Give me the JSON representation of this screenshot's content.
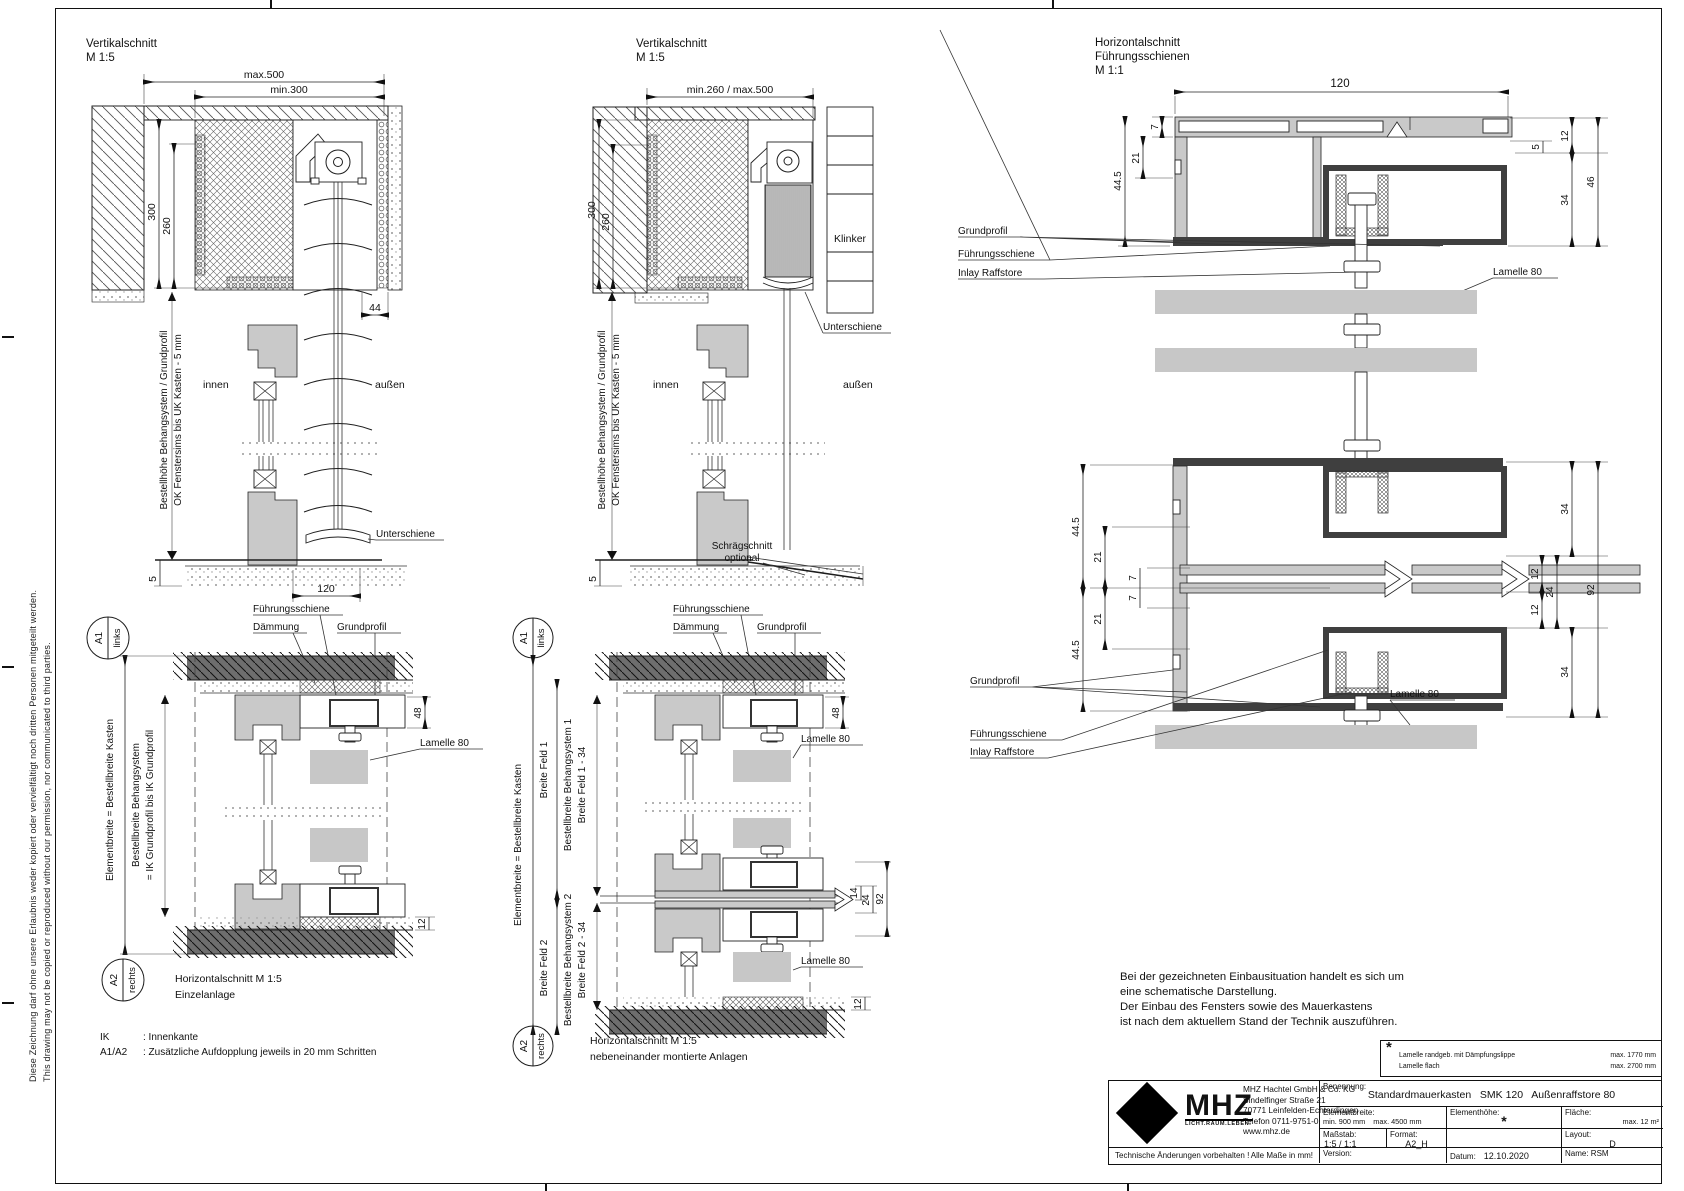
{
  "sheet": {
    "copyright_de": "Diese Zeichnung darf ohne unsere Erlaubnis weder kopiert oder vervielfältigt noch dritten Personen mitgeteilt werden.",
    "copyright_en": "This drawing may not be copied or reproduced without our permission, nor communicated to third parties."
  },
  "vs1": {
    "title": "Vertikalschnitt",
    "scale": "M 1:5",
    "d_max": "max.500",
    "d_min": "min.300",
    "d_300": "300",
    "d_260": "260",
    "d_44": "44",
    "d_120": "120",
    "d_5": "5",
    "innen": "innen",
    "aussen": "außen",
    "unterschiene": "Unterschiene",
    "v1": "Bestellhöhe Behangsystem / Grundprofil",
    "v2": "OK Fenstersims  bis UK Kasten - 5 mm"
  },
  "vs2": {
    "title": "Vertikalschnitt",
    "scale": "M 1:5",
    "d_span": "min.260 / max.500",
    "d_300": "300",
    "d_260": "260",
    "d_5": "5",
    "innen": "innen",
    "aussen": "außen",
    "klinker": "Klinker",
    "unterschiene": "Unterschiene",
    "schraeg1": "Schrägschnitt",
    "schraeg2": "optional",
    "v1": "Bestellhöhe Behangsystem / Grundprofil",
    "v2": "OK Fenstersims  bis UK Kasten - 5 mm"
  },
  "hs11": {
    "title_1": "Horizontalschnitt",
    "title_2": "Führungsschienen",
    "scale": "M 1:1",
    "d_120": "120",
    "d_7": "7",
    "d_21": "21",
    "d_445": "44.5",
    "d_5": "5",
    "d_12": "12",
    "d_34": "34",
    "d_46": "46",
    "lbl_grundprofil": "Grundprofil",
    "lbl_fuehrung": "Führungsschiene",
    "lbl_inlay": "Inlay Raffstore",
    "lbl_lamelle": "Lamelle 80",
    "lbl_grundprofil2": "Grundprofil",
    "lbl_fuehrung2": "Führungsschiene",
    "lbl_inlay2": "Inlay Raffstore",
    "lbl_lamelle2": "Lamelle 80",
    "m_445a": "44.5",
    "m_21a": "21",
    "m_7a": "7",
    "m_7b": "7",
    "m_21b": "21",
    "m_445b": "44.5",
    "m_34a": "34",
    "m_12a": "12",
    "m_24": "24",
    "m_12b": "12",
    "m_34b": "34",
    "m_92": "92"
  },
  "hs15a": {
    "a1": "A1",
    "a1dir": "links",
    "a2": "A2",
    "a2dir": "rechts",
    "lbl_fuehrung": "Führungsschiene",
    "lbl_daemmung": "Dämmung",
    "lbl_grund": "Grundprofil",
    "lbl_lamelle": "Lamelle 80",
    "dim_48": "48",
    "dim_12": "12",
    "v_element": "Elementbreite = Bestellbreite Kasten",
    "v_bestell1": "Bestellbreite Behangsystem",
    "v_bestell2": "= IK Grundprofil bis IK Grundprofil",
    "title": "Horizontalschnitt M 1:5",
    "subtitle": "Einzelanlage",
    "ik_term": "IK",
    "ik_def": ": Innenkante",
    "a_term": "A1/A2",
    "a_def": ": Zusätzliche Aufdopplung jeweils in 20 mm Schritten"
  },
  "hs15b": {
    "a1": "A1",
    "a1dir": "links",
    "a2": "A2",
    "a2dir": "rechts",
    "lbl_fuehrung": "Führungsschiene",
    "lbl_daemmung": "Dämmung",
    "lbl_grund": "Grundprofil",
    "lbl_lamelle1": "Lamelle 80",
    "lbl_lamelle2": "Lamelle 80",
    "dim_48": "48",
    "dim_14": "14",
    "dim_24": "24",
    "dim_92": "92",
    "dim_12": "12",
    "v_element": "Elementbreite = Bestellbreite Kasten",
    "v_feld1": "Breite Feld 1",
    "v_bs1": "Bestellbreite Behangsystem 1",
    "v_bf1": "Breite Feld 1 - 34",
    "v_feld2": "Breite Feld 2",
    "v_bs2": "Bestellbreite Behangsystem 2",
    "v_bf2": "Breite Feld 2 - 34",
    "title": "Horizontalschnitt M 1:5",
    "subtitle": "nebeneinander montierte Anlagen"
  },
  "note": {
    "line1": "Bei der gezeichneten Einbausituation handelt es sich um",
    "line2": "eine schematische Darstellung.",
    "line3": "Der Einbau des Fensters sowie des Mauerkastens",
    "line4": "ist nach dem aktuellem Stand der Technik auszuführen."
  },
  "star_box": {
    "star": "*",
    "row1_label": "Lamelle randgeb. mit Dämpfungslippe",
    "row1_value": "max. 1770 mm",
    "row2_label": "Lamelle flach",
    "row2_value": "max. 2700 mm"
  },
  "title_block": {
    "logo_text": "MHZ",
    "logo_tagline": "LICHT.RAUM.LEBEN.",
    "company_line1": "MHZ  Hachtel GmbH & Co. KG",
    "company_line2": "Sindelfinger Straße 21",
    "company_line3": "70771 Leinfelden-Echterdingen",
    "company_line4": "Telefon 0711-9751-0",
    "company_line5": "www.mhz.de",
    "footer_left": "Technische Änderungen vorbehalten !",
    "footer_right": "Alle Maße in mm!",
    "benennung_label": "Benennung:",
    "benennung_value": "Standardmauerkasten   SMK 120   Außenraffstore 80",
    "elementbreite_label": "Elementbreite:",
    "elementbreite_value": "min. 900 mm    max. 4500 mm",
    "elementhoehe_label": "Elementhöhe:",
    "elementhoehe_value": "*",
    "flaeche_label": "Fläche:",
    "flaeche_value": "max. 12 m²",
    "massstab_label": "Maßstab:",
    "massstab_value": "1:5 / 1:1",
    "format_label": "Format:",
    "format_value": "A2_H",
    "layout_label": "Layout:",
    "layout_value": "D",
    "version_label": "Version:",
    "datum_label": "Datum:",
    "datum_value": "12.10.2020",
    "name_label": "Name: RSM"
  }
}
